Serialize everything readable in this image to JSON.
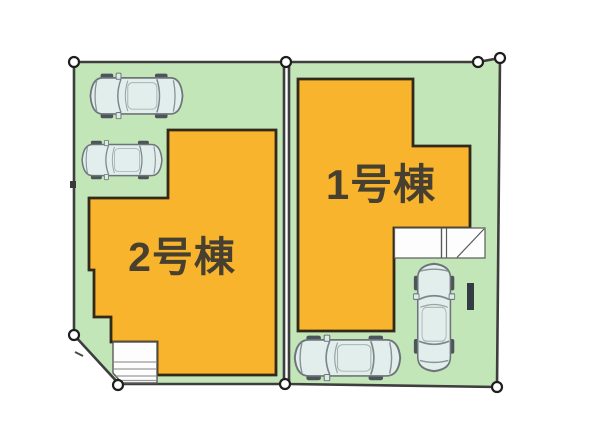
{
  "site_plan": {
    "buildings": [
      {
        "id": "1",
        "label": "1号棟"
      },
      {
        "id": "2",
        "label": "2号棟"
      }
    ],
    "colors": {
      "parcel_green": "#c3e6b8",
      "building_orange": "#f8b42c",
      "outline_dark": "#3e3e3e",
      "building_outline": "#33291b",
      "label_text": "#473f30",
      "car_body": "#e1eeeb",
      "wall_segment": "#333c42"
    },
    "cars": 4,
    "boundary_markers": 8
  }
}
